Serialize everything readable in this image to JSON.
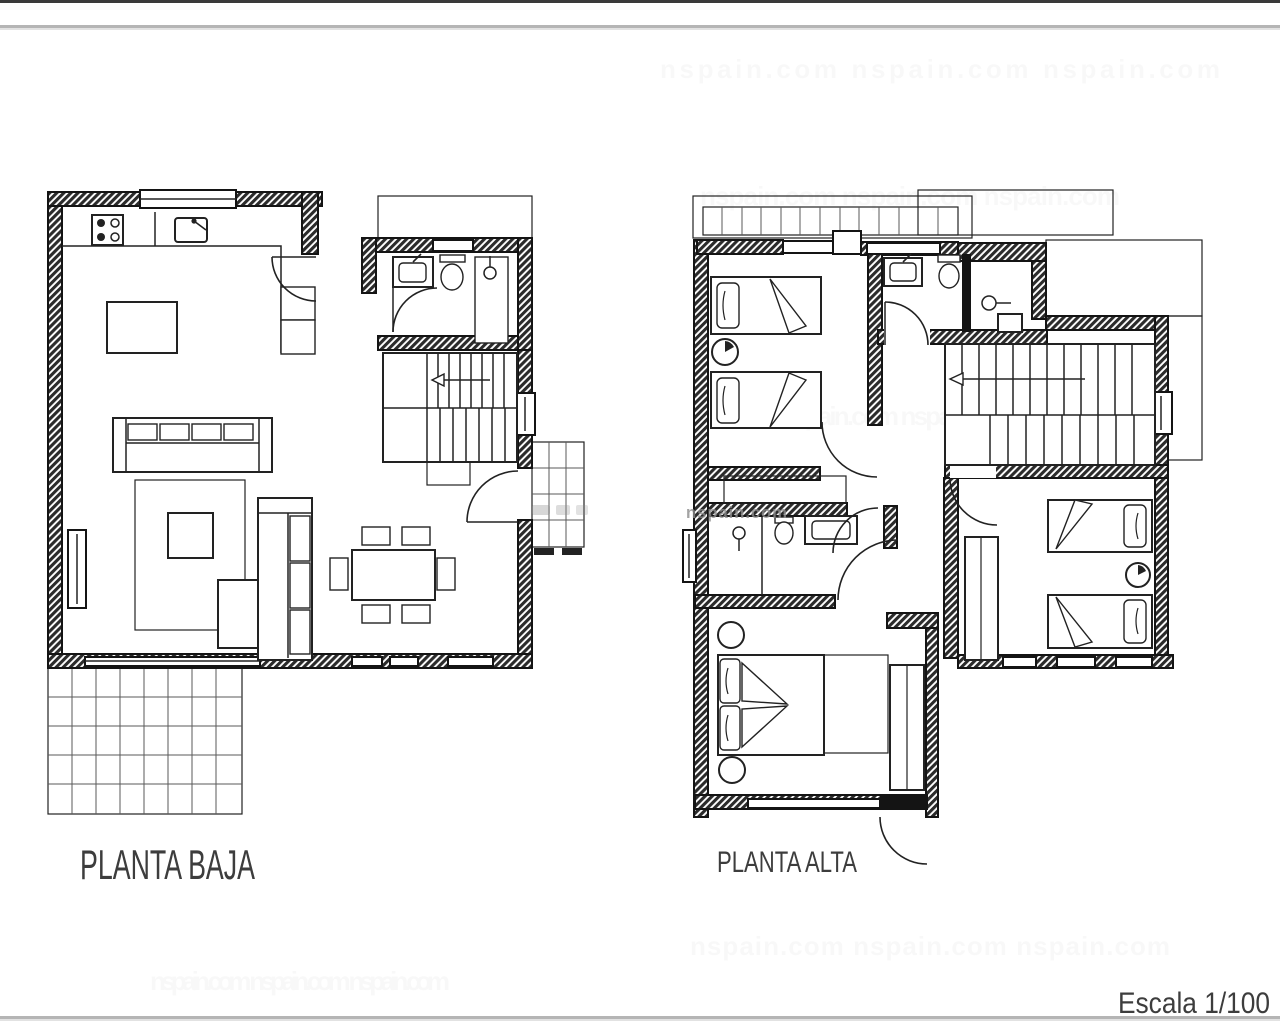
{
  "document": {
    "type": "architectural-floor-plan-sheet",
    "sheet_background": "#ffffff"
  },
  "colors": {
    "paper": "#ffffff",
    "wall": "#141414",
    "ink": "#222222",
    "grid": "#5a5a5a",
    "label": "#3d3d3d",
    "divider": "#b5b5b5",
    "watermark": "#8d8d8d"
  },
  "plans": {
    "ground_floor": {
      "label": "PLANTA BAJA",
      "rooms": [
        "kitchen",
        "living-room",
        "dining-area",
        "bathroom",
        "hallway",
        "staircase",
        "terrace",
        "entrance-porch"
      ],
      "fixtures": [
        "stove-icon",
        "kitchen-sink-icon",
        "kitchen-island",
        "pantry-cabinets",
        "washbasin-icon",
        "toilet-icon",
        "shower-icon",
        "sofa",
        "rug",
        "coffee-table",
        "chaise-longue",
        "side-table",
        "dining-table",
        "dining-chairs-x6",
        "stairs-arrow-icon",
        "door-swing-arcs",
        "window-openings"
      ]
    },
    "upper_floor": {
      "label": "PLANTA ALTA",
      "rooms": [
        "bedroom-1",
        "bedroom-2",
        "master-bedroom",
        "bathroom",
        "ensuite-bathroom",
        "hallway",
        "staircase",
        "balcony",
        "roof-terrace"
      ],
      "fixtures": [
        "single-beds-x2",
        "double-bed",
        "bedside-tables",
        "wardrobes",
        "washbasin-icon",
        "toilet-icon",
        "shower-head-icon",
        "stairs-arrow-icon",
        "door-swing-arcs",
        "window-openings"
      ]
    }
  },
  "scale": {
    "label": "Escala 1/100"
  },
  "watermark": {
    "text": "nspain.com",
    "row": "nspain.com      nspain.com      nspain.com"
  }
}
